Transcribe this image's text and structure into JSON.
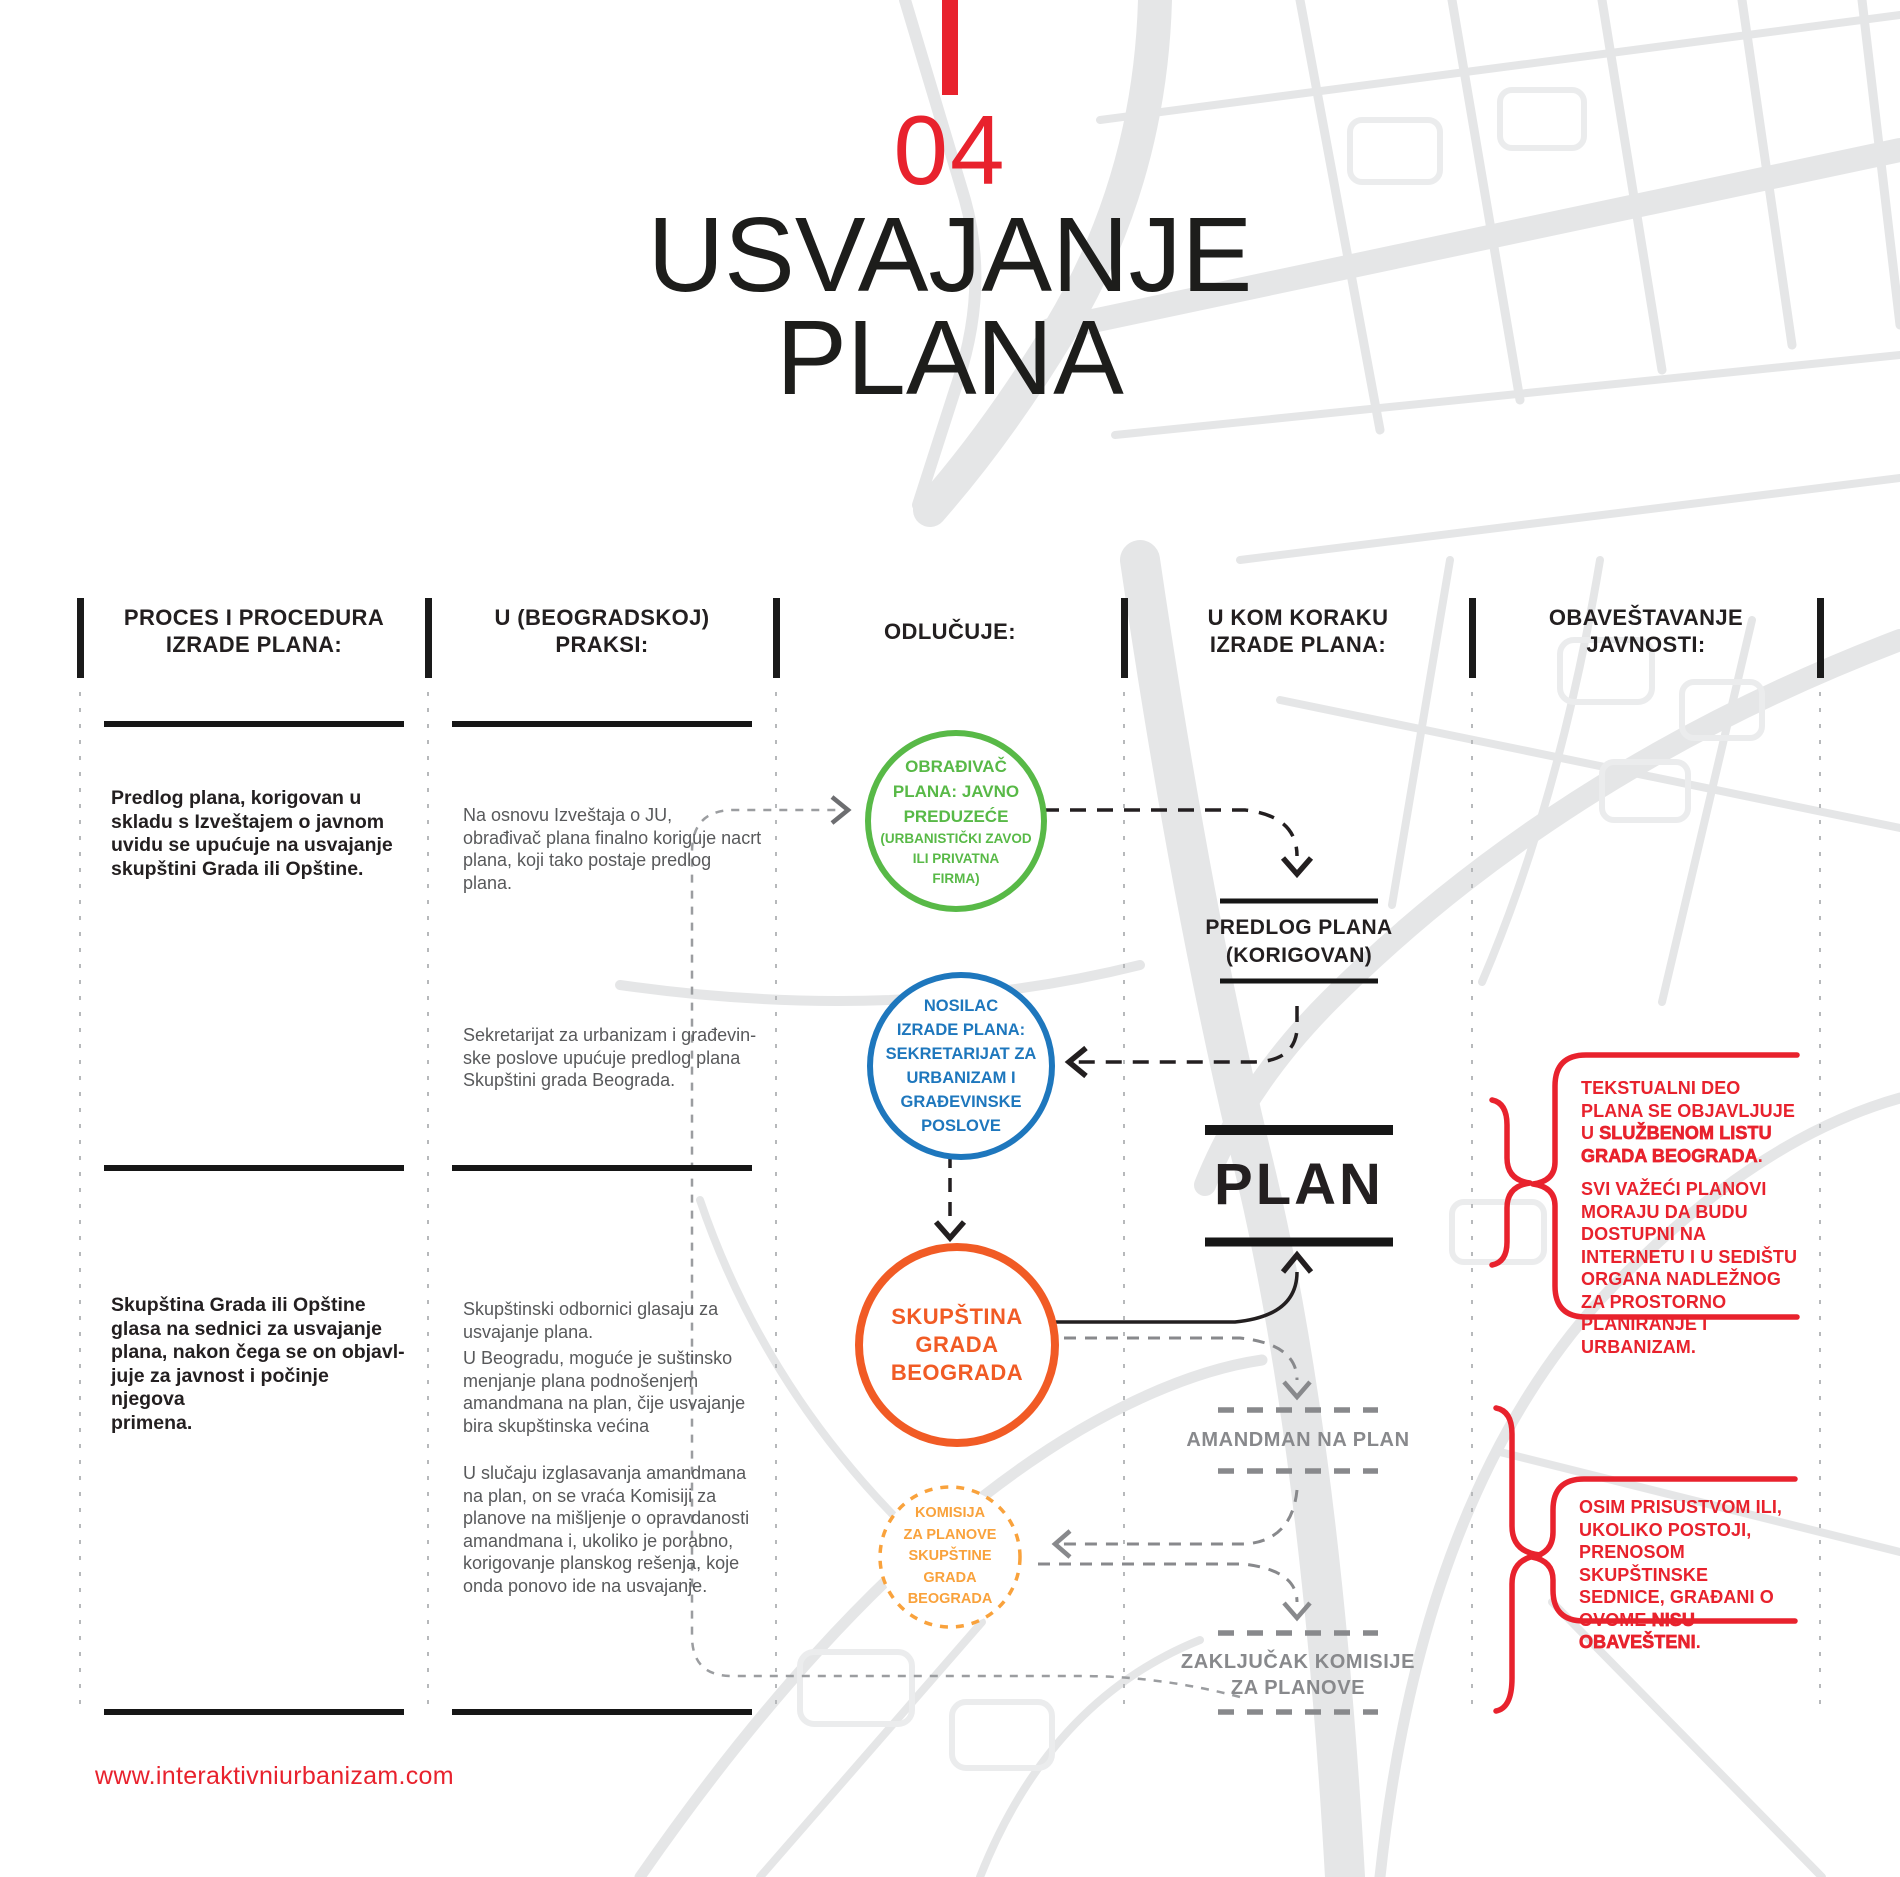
{
  "header": {
    "chapter_number": "04",
    "title_line1": "USVAJANJE",
    "title_line2": "PLANA"
  },
  "footer": {
    "url": "www.interaktivniurbanizam.com"
  },
  "columns": [
    {
      "line1": "PROCES I PROCEDURA",
      "line2": "IZRADE PLANA:"
    },
    {
      "line1": "U (BEOGRADSKOJ)",
      "line2": "PRAKSI:"
    },
    {
      "line1": "ODLUČUJE:",
      "line2": ""
    },
    {
      "line1": "U KOM KORAKU",
      "line2": "IZRADE PLANA:"
    },
    {
      "line1": "OBAVEŠTAVANJE",
      "line2": "JAVNOSTI:"
    }
  ],
  "process": {
    "block1": [
      "Predlog plana, korigovan u",
      "skladu s Izveštajem o javnom",
      "uvidu se upućuje na usvajanje",
      "skupštini Grada ili Opštine."
    ],
    "block2": [
      "Skupština Grada ili Opštine",
      "glasa na sednici za usvajanje",
      "plana, nakon čega se on objavl-",
      "juje za javnost i počinje njegova",
      "primena."
    ]
  },
  "practice": {
    "block1": [
      "Na osnovu Izveštaja o JU,",
      "obrađivač plana finalno koriguje nacrt",
      "plana, koji tako postaje predlog plana."
    ],
    "block2": [
      "Sekretarijat za urbanizam i građevin-",
      "ske poslove upućuje predlog plana",
      "Skupštini grada Beograda."
    ],
    "block3": [
      "Skupštinski odbornici glasaju za",
      "usvajanje plana."
    ],
    "block4": [
      "U Beogradu, moguće je suštinsko",
      "menjanje plana podnošenjem",
      "amandmana na plan, čije usvajanje",
      "bira skupštinska većina"
    ],
    "block5": [
      "U slučaju izglasavanja amandmana",
      "na plan, on se vraća Komisiji za",
      "planove na mišljenje o opravdanosti",
      "amandmana i, ukoliko je porabno,",
      "korigovanje planskog rešenja, koje",
      "onda ponovo ide na usvajanje."
    ]
  },
  "decides": {
    "green": {
      "main": [
        "OBRAĐIVAČ",
        "PLANA: JAVNO",
        "PREDUZEĆE"
      ],
      "sub": [
        "(URBANISTIČKI ZAVOD",
        "ILI PRIVATNA",
        "FIRMA)"
      ]
    },
    "blue": {
      "main": [
        "NOSILAC",
        "IZRADE PLANA:",
        "SEKRETARIJAT ZA",
        "URBANIZAM I",
        "GRAĐEVINSKE",
        "POSLOVE"
      ]
    },
    "orange": {
      "main": [
        "SKUPŠTINA",
        "GRADA",
        "BEOGRADA"
      ]
    },
    "komisija": {
      "main": [
        "KOMISIJA",
        "ZA PLANOVE",
        "SKUPŠTINE GRADA",
        "BEOGRADA"
      ]
    }
  },
  "steps": {
    "predlog_line1": "PREDLOG PLANA",
    "predlog_line2": "(KORIGOVAN)",
    "plan": "PLAN",
    "amandman": "AMANDMAN NA PLAN",
    "zakljucak_line1": "ZAKLJUČAK KOMISIJE",
    "zakljucak_line2": "ZA PLANOVE"
  },
  "public_info": {
    "box1_p1_normal": "TEKSTUALNI DEO PLANA SE OBJAVLJUJE U ",
    "box1_p1_bold": "SLUŽBENOM LISTU GRADA BEOGRADA",
    "box1_p1_tail": ".",
    "box1_p2": "SVI VAŽEĆI PLANOVI MORAJU DA BUDU DOSTUPNI  NA INTERNETU I U SEDIŠTU ORGANA NADLEŽNOG ZA PROSTORNO PLANIRANJE I URBANIZAM.",
    "box2_p1_normal": "OSIM PRISUSTVOM ILI, UKOLIKO POSTOJI, PRENOSOM SKUPŠTINSKE SEDNICE, GRAĐANI O OVOME ",
    "box2_p1_bold": "NISU OBAVEŠTENI",
    "box2_p1_tail": "."
  },
  "colors": {
    "red": "#e8222d",
    "green": "#58b947",
    "blue": "#1e77bd",
    "orange": "#f15b25",
    "light_orange": "#f9a23c",
    "gray_text": "#58595b",
    "flow_gray": "#88898c",
    "map_gray": "#e7e8e9"
  }
}
